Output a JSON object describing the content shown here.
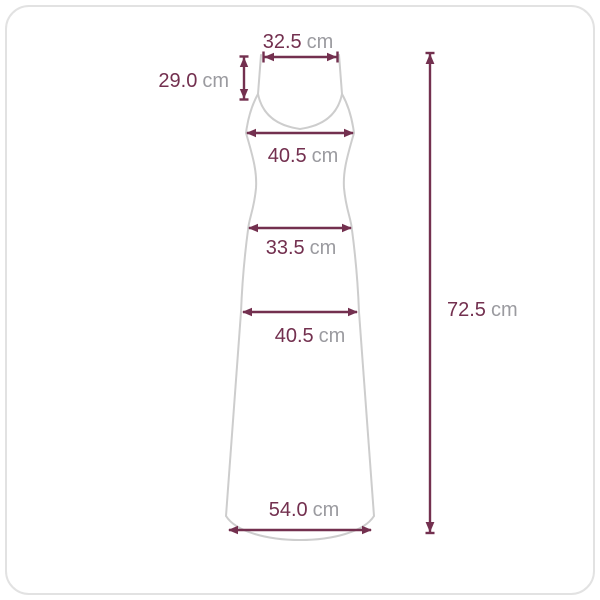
{
  "diagram": {
    "kind": "garment-size-measurement-diagram",
    "garment": "sleeveless-v-neck-maxi-dress",
    "colors": {
      "accent": "#73304f",
      "unit_text": "#9b9ba0",
      "garment_outline": "#cdcdcd",
      "panel_border": "#e2e2e2",
      "background": "#ffffff"
    }
  },
  "measurements": {
    "shoulder_width": {
      "value": "32.5",
      "unit": "cm"
    },
    "strap_length": {
      "value": "29.0",
      "unit": "cm"
    },
    "bust_width": {
      "value": "40.5",
      "unit": "cm"
    },
    "waist_width": {
      "value": "33.5",
      "unit": "cm"
    },
    "hip_width": {
      "value": "40.5",
      "unit": "cm"
    },
    "hem_width": {
      "value": "54.0",
      "unit": "cm"
    },
    "total_length": {
      "value": "72.5",
      "unit": "cm"
    }
  }
}
